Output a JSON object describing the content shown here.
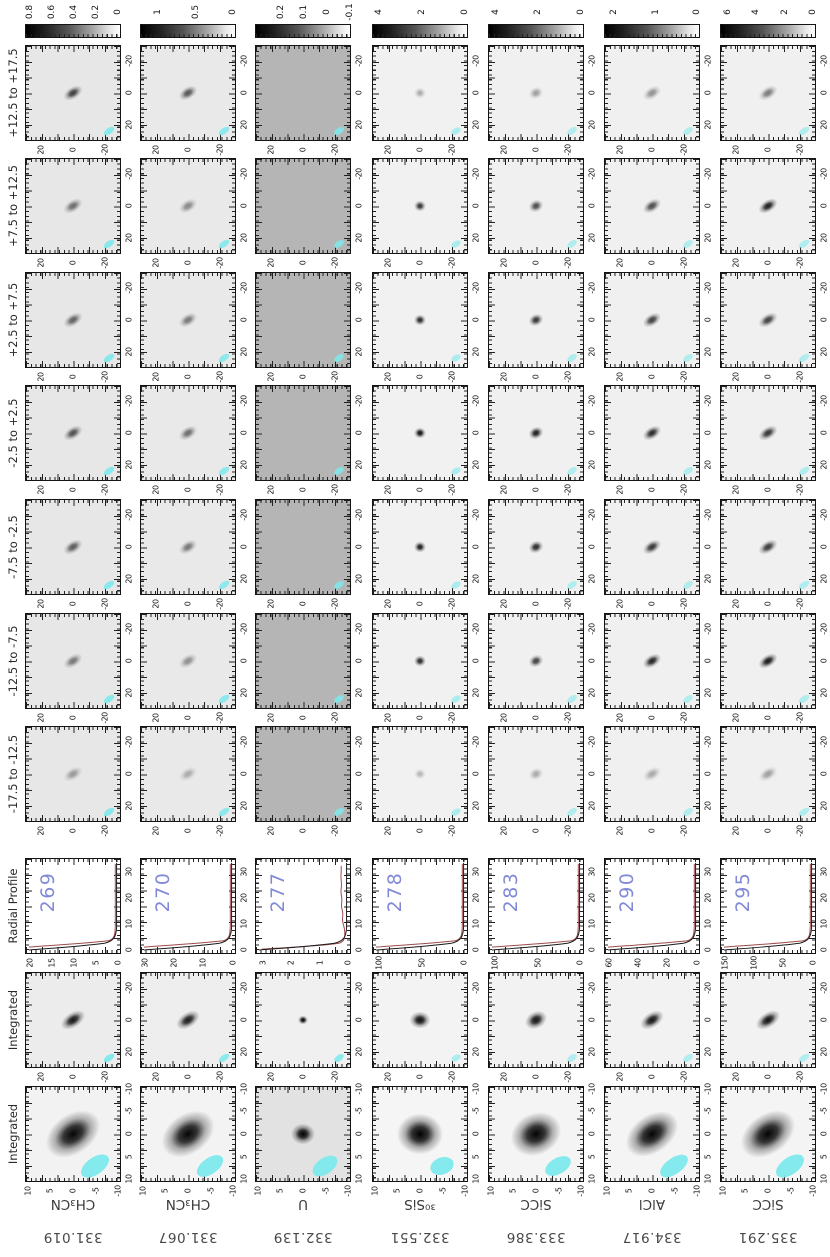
{
  "page": {
    "background": "#ffffff"
  },
  "colors": {
    "beam_cyan": "#7de9ec",
    "profile_line_black": "#1a1a1a",
    "profile_fit_red": "#9e4a4a",
    "radial_number_blue": "#8289d6",
    "axis_black": "#141414",
    "colorbar_dark_end": "#000000",
    "colorbar_light_end": "#ffffff"
  },
  "row_labels": {
    "channels": [
      "+12.5 to +17.5",
      "+7.5 to +12.5",
      "+2.5 to +7.5",
      "-2.5 to +2.5",
      "-7.5 to -2.5",
      "-12.5 to -7.5",
      "-17.5 to -12.5"
    ],
    "radial": "Radial Profile",
    "integrated": "Integrated",
    "integrated_zoom": "Integrated"
  },
  "axis_ticks": {
    "map_bottom": {
      "labels": [
        "20",
        "0",
        "-20"
      ],
      "fracs": [
        0.17,
        0.5,
        0.83
      ]
    },
    "map_right": {
      "labels": [
        "-20",
        "0",
        "20"
      ],
      "fracs": [
        0.17,
        0.5,
        0.83
      ]
    },
    "zoom_bottom": {
      "labels": [
        "10",
        "5",
        "0",
        "-5",
        "-10"
      ],
      "fracs": [
        0.03,
        0.265,
        0.5,
        0.735,
        0.97
      ]
    },
    "zoom_right": {
      "labels": [
        "-10",
        "-5",
        "0",
        "5",
        "10"
      ],
      "fracs": [
        0.03,
        0.265,
        0.5,
        0.735,
        0.97
      ]
    },
    "radial_right": {
      "labels": [
        "30",
        "20",
        "10",
        "0"
      ],
      "fracs": [
        0.15,
        0.42,
        0.69,
        0.96
      ]
    }
  },
  "chart_data": {
    "type": "heatmap",
    "description_columns": "7 spectral-line columns; rows top-to-bottom: colorbar, 7 velocity channels (+12.5 to +17.5 km/s down to -17.5 to -12.5), radial profile, integrated map, zoomed integrated map, species label",
    "columns": [
      {
        "frequency": "331.019",
        "species": "CH₃CN",
        "radial_number": "269",
        "colorbar_ticks": [
          {
            "v": "0.8",
            "f": 0.05
          },
          {
            "v": "0.6",
            "f": 0.28
          },
          {
            "v": "0.4",
            "f": 0.51
          },
          {
            "v": "0.2",
            "f": 0.74
          },
          {
            "v": "0",
            "f": 0.97
          }
        ],
        "radial_flux_ticks": [
          {
            "v": "20",
            "f": 0.05
          },
          {
            "v": "15",
            "f": 0.28
          },
          {
            "v": "10",
            "f": 0.51
          },
          {
            "v": "5",
            "f": 0.74
          },
          {
            "v": "0",
            "f": 0.97
          }
        ],
        "channel_strengths": [
          0.75,
          0.55,
          0.6,
          0.68,
          0.62,
          0.5,
          0.35
        ],
        "integrated_strength": 0.92,
        "zoom_strength": 0.98,
        "blob": {
          "w": 21,
          "h": 12,
          "rot": -32
        },
        "integrated_blob": {
          "w": 27,
          "h": 15,
          "rot": -33
        },
        "zoom_blob": {
          "w": 60,
          "h": 40,
          "rot": -35
        },
        "channel_bg": "#e7e7e7",
        "channel_noise": "streak",
        "integrated_bg": "#ececec",
        "integrated_noise": "mottle",
        "zoom_bg": "#f2f2f2",
        "zoom_noise": "mottle",
        "radial_fit_wiggly": false,
        "beam_zoom": {
          "w": 32,
          "h": 17,
          "rot": -35
        },
        "beam_small": {
          "w": 12,
          "h": 6,
          "rot": -35
        },
        "beam_opacity": 0.9
      },
      {
        "frequency": "331.067",
        "species": "CH₃CN",
        "radial_number": "270",
        "colorbar_ticks": [
          {
            "v": "1",
            "f": 0.19
          },
          {
            "v": "0.5",
            "f": 0.58
          },
          {
            "v": "0",
            "f": 0.97
          }
        ],
        "radial_flux_ticks": [
          {
            "v": "30",
            "f": 0.05
          },
          {
            "v": "20",
            "f": 0.355
          },
          {
            "v": "10",
            "f": 0.66
          },
          {
            "v": "0",
            "f": 0.965
          }
        ],
        "channel_strengths": [
          0.65,
          0.42,
          0.5,
          0.55,
          0.5,
          0.4,
          0.28
        ],
        "integrated_strength": 0.9,
        "zoom_strength": 0.98,
        "blob": {
          "w": 20,
          "h": 12,
          "rot": -32
        },
        "integrated_blob": {
          "w": 26,
          "h": 15,
          "rot": -33
        },
        "zoom_blob": {
          "w": 58,
          "h": 40,
          "rot": -35
        },
        "channel_bg": "#e9e9e9",
        "channel_noise": "streak",
        "integrated_bg": "#eeeeee",
        "integrated_noise": "mottle",
        "zoom_bg": "#f3f3f3",
        "zoom_noise": "faint",
        "radial_fit_wiggly": false,
        "beam_zoom": {
          "w": 30,
          "h": 16,
          "rot": -35
        },
        "beam_small": {
          "w": 12,
          "h": 6,
          "rot": -35
        },
        "beam_opacity": 0.85
      },
      {
        "frequency": "332.139",
        "species": "U",
        "radial_number": "277",
        "colorbar_ticks": [
          {
            "v": "0.2",
            "f": 0.27
          },
          {
            "v": "0.1",
            "f": 0.51
          },
          {
            "v": "0",
            "f": 0.75
          },
          {
            "v": "-0.1",
            "f": 0.99
          }
        ],
        "radial_flux_ticks": [
          {
            "v": "3",
            "f": 0.08
          },
          {
            "v": "2",
            "f": 0.38
          },
          {
            "v": "1",
            "f": 0.68
          },
          {
            "v": "0",
            "f": 0.97
          }
        ],
        "channel_strengths": [
          0,
          0,
          0,
          0,
          0,
          0,
          0
        ],
        "integrated_strength": 1.0,
        "zoom_strength": 1.0,
        "blob": {
          "w": 0,
          "h": 0,
          "rot": 0
        },
        "integrated_blob": {
          "w": 10,
          "h": 9,
          "rot": 0
        },
        "zoom_blob": {
          "w": 24,
          "h": 21,
          "rot": 0
        },
        "channel_bg": "#b5b5b5",
        "channel_noise": "heavy",
        "integrated_bg": "#f0f0f0",
        "integrated_noise": "mottle",
        "zoom_bg": "#e2e2e2",
        "zoom_noise": "heavy",
        "radial_fit_wiggly": true,
        "beam_zoom": {
          "w": 28,
          "h": 16,
          "rot": -35
        },
        "beam_small": {
          "w": 11,
          "h": 6,
          "rot": -35
        },
        "beam_opacity": 0.85
      },
      {
        "frequency": "332.551",
        "species": "³⁰SiS",
        "radial_number": "278",
        "colorbar_ticks": [
          {
            "v": "4",
            "f": 0.07
          },
          {
            "v": "2",
            "f": 0.52
          },
          {
            "v": "0",
            "f": 0.97
          }
        ],
        "radial_flux_ticks": [
          {
            "v": "100",
            "f": 0.07
          },
          {
            "v": "50",
            "f": 0.52
          },
          {
            "v": "0",
            "f": 0.96
          }
        ],
        "channel_strengths": [
          0.3,
          0.8,
          0.85,
          0.95,
          0.9,
          0.85,
          0.25
        ],
        "integrated_strength": 0.95,
        "zoom_strength": 1.0,
        "blob": {
          "w": 12,
          "h": 11,
          "rot": 0
        },
        "integrated_blob": {
          "w": 21,
          "h": 17,
          "rot": 0
        },
        "zoom_blob": {
          "w": 46,
          "h": 41,
          "rot": 0
        },
        "channel_bg": "#f1f1f1",
        "channel_noise": "faint",
        "integrated_bg": "#f3f3f3",
        "integrated_noise": "faint",
        "zoom_bg": "#f5f5f5",
        "zoom_noise": "faint",
        "radial_fit_wiggly": false,
        "beam_zoom": {
          "w": 24,
          "h": 17,
          "rot": -20
        },
        "beam_small": {
          "w": 10,
          "h": 6,
          "rot": -30
        },
        "beam_opacity": 0.6
      },
      {
        "frequency": "333.386",
        "species": "SiCC",
        "radial_number": "283",
        "colorbar_ticks": [
          {
            "v": "4",
            "f": 0.08
          },
          {
            "v": "2",
            "f": 0.52
          },
          {
            "v": "0",
            "f": 0.97
          }
        ],
        "radial_flux_ticks": [
          {
            "v": "100",
            "f": 0.07
          },
          {
            "v": "50",
            "f": 0.52
          },
          {
            "v": "0",
            "f": 0.96
          }
        ],
        "channel_strengths": [
          0.35,
          0.7,
          0.8,
          0.9,
          0.85,
          0.75,
          0.3
        ],
        "integrated_strength": 0.93,
        "zoom_strength": 0.99,
        "blob": {
          "w": 15,
          "h": 12,
          "rot": -25
        },
        "integrated_blob": {
          "w": 23,
          "h": 17,
          "rot": -28
        },
        "zoom_blob": {
          "w": 52,
          "h": 42,
          "rot": -25
        },
        "channel_bg": "#f0f0f0",
        "channel_noise": "faint",
        "integrated_bg": "#f2f2f2",
        "integrated_noise": "faint",
        "zoom_bg": "#f4f4f4",
        "zoom_noise": "faint",
        "radial_fit_wiggly": false,
        "beam_zoom": {
          "w": 28,
          "h": 16,
          "rot": -30
        },
        "beam_small": {
          "w": 11,
          "h": 6,
          "rot": -35
        },
        "beam_opacity": 0.55
      },
      {
        "frequency": "334.917",
        "species": "AlCl",
        "radial_number": "290",
        "colorbar_ticks": [
          {
            "v": "2",
            "f": 0.1
          },
          {
            "v": "1",
            "f": 0.54
          },
          {
            "v": "0",
            "f": 0.97
          }
        ],
        "radial_flux_ticks": [
          {
            "v": "60",
            "f": 0.05
          },
          {
            "v": "40",
            "f": 0.355
          },
          {
            "v": "20",
            "f": 0.66
          },
          {
            "v": "0",
            "f": 0.965
          }
        ],
        "channel_strengths": [
          0.4,
          0.7,
          0.75,
          0.85,
          0.8,
          0.88,
          0.3
        ],
        "integrated_strength": 0.93,
        "zoom_strength": 0.99,
        "blob": {
          "w": 20,
          "h": 12,
          "rot": -32
        },
        "integrated_blob": {
          "w": 26,
          "h": 15,
          "rot": -33
        },
        "zoom_blob": {
          "w": 58,
          "h": 38,
          "rot": -35
        },
        "channel_bg": "#f0f0f0",
        "channel_noise": "faint",
        "integrated_bg": "#f2f2f2",
        "integrated_noise": "faint",
        "zoom_bg": "#f4f4f4",
        "zoom_noise": "faint",
        "radial_fit_wiggly": false,
        "beam_zoom": {
          "w": 32,
          "h": 16,
          "rot": -35
        },
        "beam_small": {
          "w": 11,
          "h": 6,
          "rot": -35
        },
        "beam_opacity": 0.55
      },
      {
        "frequency": "335.291",
        "species": "SiCC",
        "radial_number": "295",
        "colorbar_ticks": [
          {
            "v": "6",
            "f": 0.08
          },
          {
            "v": "4",
            "f": 0.38
          },
          {
            "v": "2",
            "f": 0.68
          },
          {
            "v": "0",
            "f": 0.97
          }
        ],
        "radial_flux_ticks": [
          {
            "v": "150",
            "f": 0.05
          },
          {
            "v": "100",
            "f": 0.355
          },
          {
            "v": "50",
            "f": 0.66
          },
          {
            "v": "0",
            "f": 0.965
          }
        ],
        "channel_strengths": [
          0.5,
          0.9,
          0.75,
          0.8,
          0.78,
          0.92,
          0.35
        ],
        "integrated_strength": 0.94,
        "zoom_strength": 0.99,
        "blob": {
          "w": 21,
          "h": 12,
          "rot": -32
        },
        "integrated_blob": {
          "w": 27,
          "h": 15,
          "rot": -33
        },
        "zoom_blob": {
          "w": 60,
          "h": 40,
          "rot": -35
        },
        "channel_bg": "#f0f0f0",
        "channel_noise": "faint",
        "integrated_bg": "#f2f2f2",
        "integrated_noise": "faint",
        "zoom_bg": "#f4f4f4",
        "zoom_noise": "faint",
        "radial_fit_wiggly": false,
        "beam_zoom": {
          "w": 32,
          "h": 17,
          "rot": -35
        },
        "beam_small": {
          "w": 12,
          "h": 6,
          "rot": -35
        },
        "beam_opacity": 0.55
      }
    ],
    "radial_profile": {
      "x_axis_radius_ticks": [
        0,
        10,
        20,
        30
      ],
      "shape": "steep central peak at radius 0 falling to ~0 by radius 5, flat to radius 35; black observed curve with red model fit overlay"
    }
  }
}
